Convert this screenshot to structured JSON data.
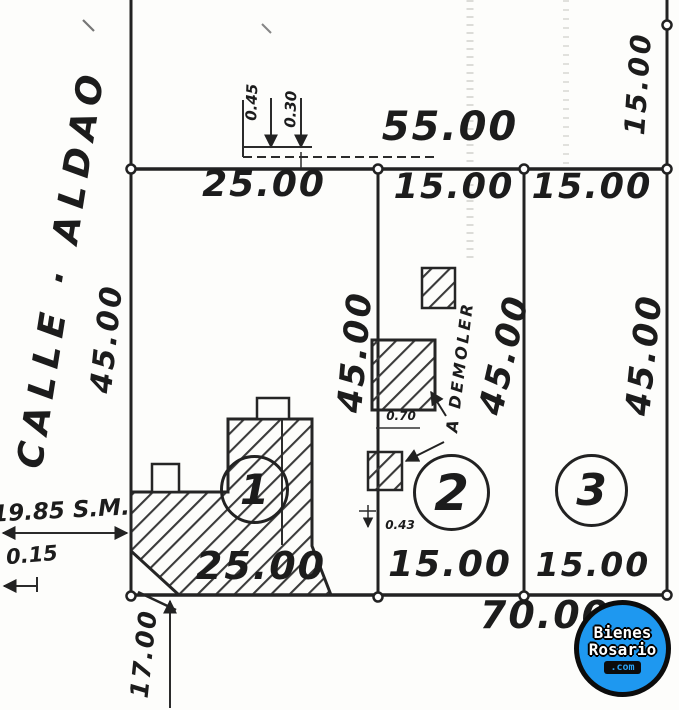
{
  "street": {
    "name": "CALLE · ALDAO"
  },
  "dimensions": {
    "front_total": "55.00",
    "bottom_total": "70.00",
    "right_margin_depth": "15.00",
    "left_margin_depth": "45.00",
    "top_offset_a": "0.45",
    "top_offset_b": "0.30",
    "left_setback": "19.85 S.M.",
    "left_offset": "0.15",
    "bottom_left": "17.00"
  },
  "lots": [
    {
      "number": "1",
      "front": "25.00",
      "back": "25.00",
      "depth": "45.00"
    },
    {
      "number": "2",
      "front": "15.00",
      "back": "15.00",
      "depth": "45.00",
      "building_note": "A DEMOLER",
      "building_offset_a": "0.70",
      "building_offset_b": "0.43"
    },
    {
      "number": "3",
      "front": "15.00",
      "back": "15.00",
      "depth": "45.00"
    }
  ],
  "watermark": {
    "line1": "Bienes",
    "line2": "Rosario",
    "line3": ".com",
    "brand_blue": "#1e98f0"
  }
}
